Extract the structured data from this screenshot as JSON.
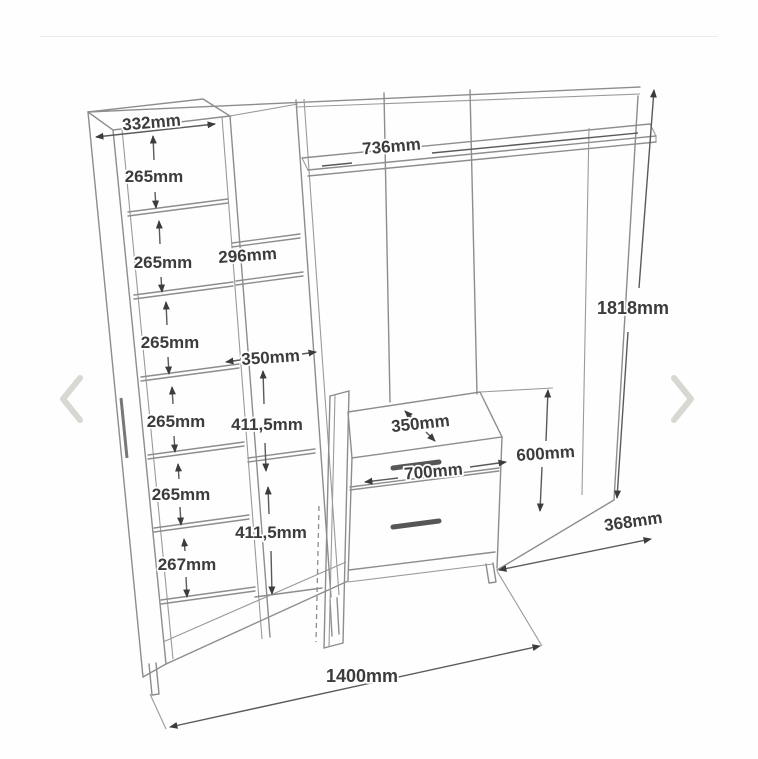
{
  "page": {
    "background": "#fefefe",
    "divider_color": "#ebebe8",
    "carousel_arrow_color": "#d8d8d3",
    "line_color": "#8d8d8d",
    "dimension_text_color": "#3c3c3c"
  },
  "carousel": {
    "prev_tooltip": "Previous image",
    "next_tooltip": "Next image"
  },
  "diagram": {
    "type": "furniture-dimension-drawing",
    "subject": "hallway wardrobe unit with open shelves, door and two-drawer base",
    "dims": {
      "top_width": "332mm",
      "shelf_gap_1": "265mm",
      "shelf_gap_2": "265mm",
      "shelf_gap_3": "265mm",
      "shelf_gap_4": "265mm",
      "shelf_gap_5": "265mm",
      "shelf_gap_6": "267mm",
      "middle_width": "296mm",
      "top_shelf_width": "736mm",
      "door_cabinet_width": "350mm",
      "door_gap_upper": "411,5mm",
      "door_gap_lower": "411,5mm",
      "base_depth_top": "350mm",
      "base_width": "700mm",
      "base_height": "600mm",
      "overall_height": "1818mm",
      "base_depth": "368mm",
      "overall_width": "1400mm"
    }
  }
}
